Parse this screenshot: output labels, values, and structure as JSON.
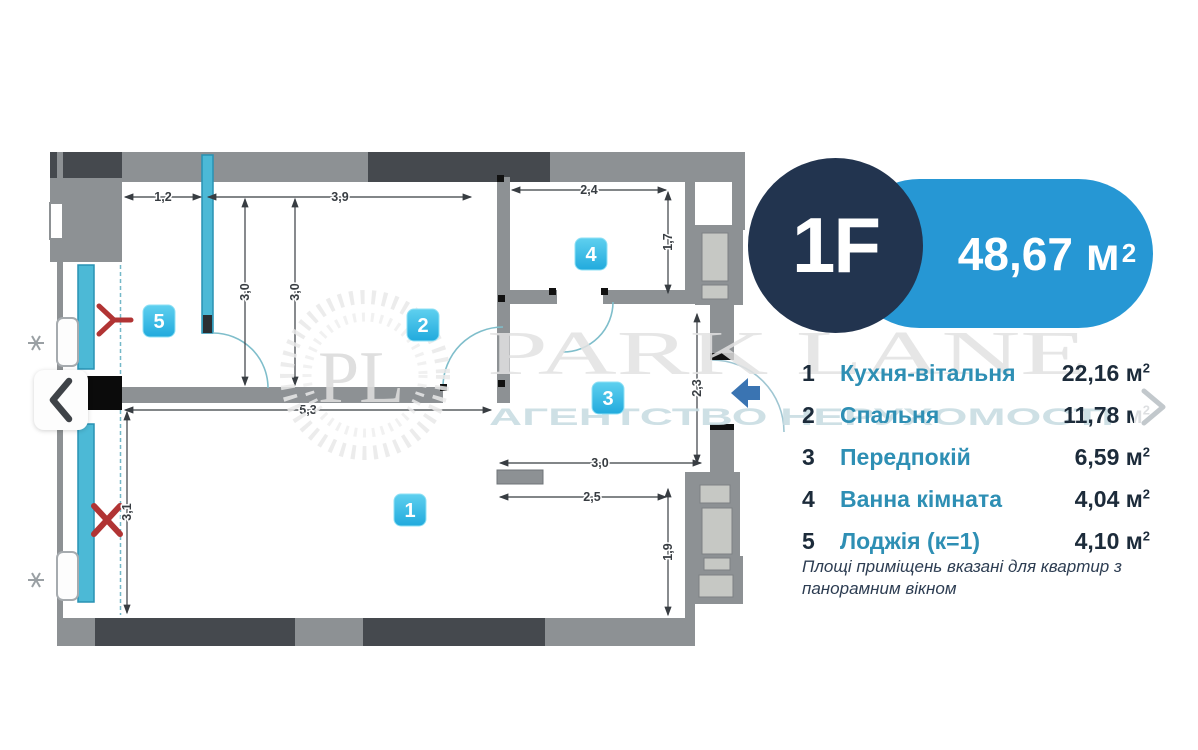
{
  "badge": {
    "unit_label": "1F",
    "area_value": "48,67",
    "area_unit": "м",
    "area_unit_sup": "2"
  },
  "legend": {
    "unit": "м",
    "unit_sup": "2",
    "rows": [
      {
        "num": "1",
        "name": "Кухня-вітальня",
        "value": "22,16"
      },
      {
        "num": "2",
        "name": "Спальня",
        "value": "11,78"
      },
      {
        "num": "3",
        "name": "Передпокій",
        "value": "6,59"
      },
      {
        "num": "4",
        "name": "Ванна кімната",
        "value": "4,04"
      },
      {
        "num": "5",
        "name": "Лоджія (к=1)",
        "value": "4,10"
      }
    ]
  },
  "note": {
    "line1": "Площі приміщень вказані для квартир з",
    "line2": "панорамним вікном"
  },
  "watermark": {
    "monogram": "PL",
    "title": "PARK LANE",
    "subtitle": "АГЕНТСТВО НЕРУХОМОСТІ"
  },
  "plan": {
    "room_labels": {
      "r1": "1",
      "r2": "2",
      "r3": "3",
      "r4": "4",
      "r5": "5"
    },
    "dims": {
      "loggia_width": "1,2",
      "bedroom_width": "3,9",
      "bath_width": "2,4",
      "bath_depth": "1,7",
      "depth_left": "3,0",
      "depth_right": "3,0",
      "living_width": "5,3",
      "hall_depth": "2,3",
      "kitchen_width": "3,0",
      "kitchen_width_inner": "2,5",
      "shaft_depth": "1,9",
      "living_depth": "3,1"
    }
  },
  "colors": {
    "wall": "#8d9194",
    "wall_dark": "#45494e",
    "window_cyan": "#4cb9d6",
    "chip_cyan": "#35bce6",
    "badge_navy": "#22344f",
    "pill_blue": "#2697d4",
    "legend_teal": "#2e8fb4",
    "marker_red": "#b13434",
    "entry_arrow_blue": "#3a74b2"
  }
}
